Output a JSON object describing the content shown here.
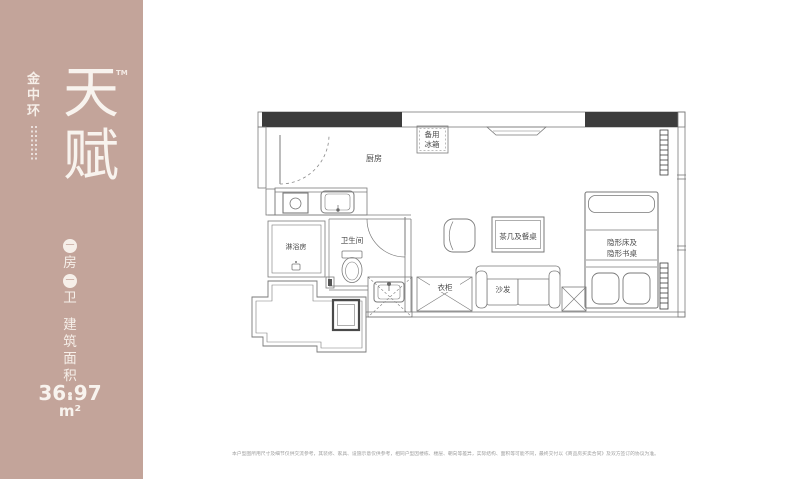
{
  "brand": {
    "logo_vertical": [
      "金",
      "中",
      "环"
    ],
    "title_vertical": [
      "天",
      "赋"
    ],
    "trademark": "TM"
  },
  "unit_info": {
    "badge1": "一",
    "room_char": "房",
    "badge2": "一",
    "bath_char": "卫",
    "area_label_vertical": [
      "建",
      "筑",
      "面",
      "积"
    ],
    "area_value": "36.97",
    "area_unit": "m²"
  },
  "floorplan": {
    "labels": {
      "kitchen": "厨房",
      "fridge": [
        "备用",
        "冰箱"
      ],
      "shower_room": "淋浴房",
      "bathroom": "卫生间",
      "wardrobe": "衣柜",
      "coffee_dining_table": "茶几及餐桌",
      "sofa": "沙发",
      "hidden_bed_desk": [
        "隐形床及",
        "隐形书桌"
      ]
    }
  },
  "disclaimer": "本户型图所用尺寸及细节仅供交流参考，其装修、家具、设施示意仅供参考，相同户型因楼栋、楼层、朝向等差异，实际结构、面积等可能不同，最终交付以《商品房买卖合同》及双方签订的协议为准。",
  "colors": {
    "sidebar": "#c3a49a",
    "wall_fill": "#3c3c3c",
    "line": "#7a7a7a",
    "label": "#4a4a4a"
  }
}
